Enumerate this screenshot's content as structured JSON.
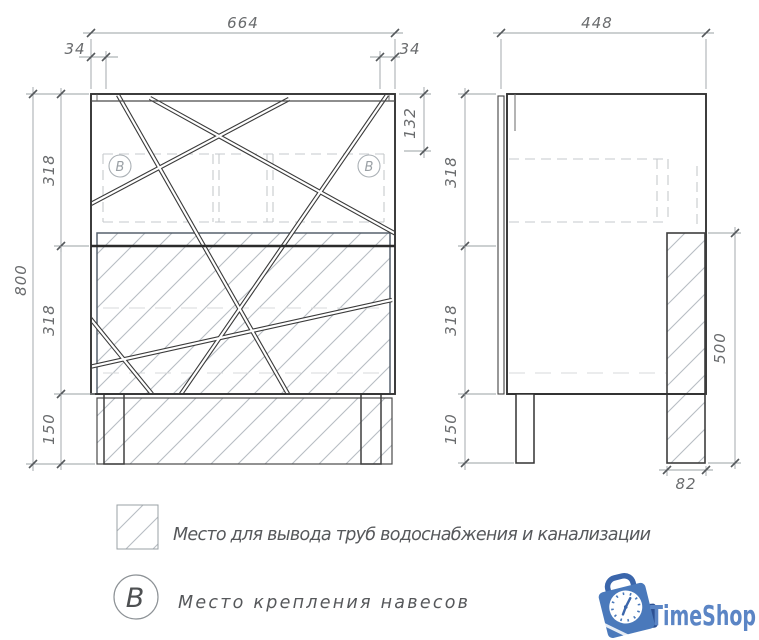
{
  "front_view": {
    "width_dim": "664",
    "left_offset_dim": "34",
    "right_offset_dim": "34",
    "hinge_dim": "132",
    "height_dim": "800",
    "upper_section_dim": "318",
    "middle_section_dim": "318",
    "base_dim": "150",
    "marker_left": "B",
    "marker_right": "B"
  },
  "side_view": {
    "depth_dim": "448",
    "upper_section_dim": "318",
    "middle_section_dim": "318",
    "base_dim": "150",
    "pipe_zone_height_dim": "500",
    "pipe_zone_width_dim": "82"
  },
  "legend": {
    "pipe_label": "Место для вывода труб водоснабжения и канализации",
    "mount_symbol": "B",
    "mount_label": "Место крепления навесов"
  },
  "logo": {
    "text": "TimeShop",
    "text_color": "#5b85c5",
    "bag_color": "#4a79bb"
  },
  "colors": {
    "outline": "#333333",
    "dimension": "#9aa0a3",
    "dim_text": "#696b6d",
    "hatch": "#b7bdc3",
    "hidden_dash": "#c6c9cc"
  }
}
